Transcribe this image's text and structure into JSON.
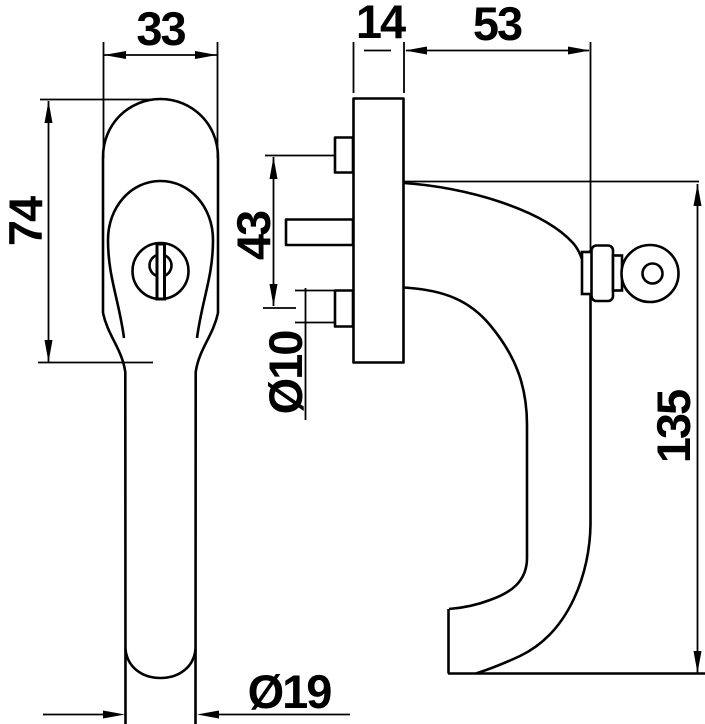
{
  "colors": {
    "ink": "#000000",
    "paper": "#ffffff"
  },
  "dimensions": {
    "front_width": "33",
    "rosette_height": "74",
    "plate_depth": "14",
    "projection": "53",
    "screw_spacing": "43",
    "screw_boss_diameter": "Ø10",
    "handle_height": "135",
    "grip_diameter": "Ø19"
  }
}
